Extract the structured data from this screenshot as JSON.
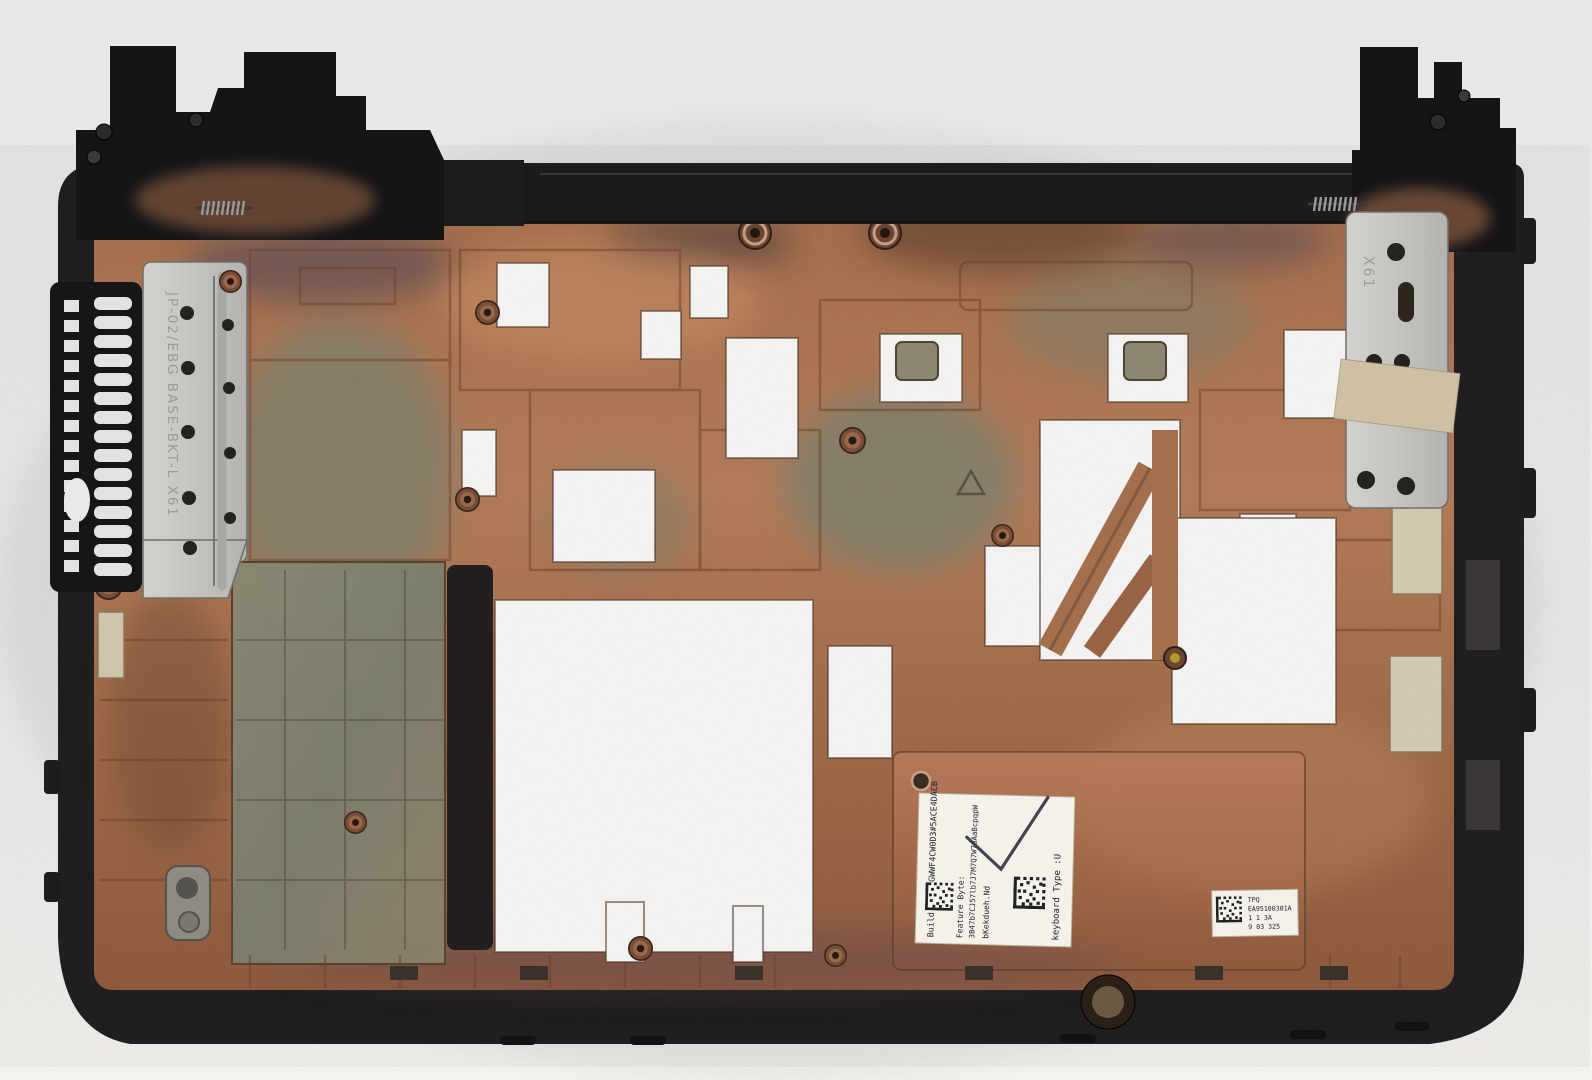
{
  "photo": {
    "subject": "laptop-bottom-case-interior"
  },
  "markings": {
    "left_bracket": {
      "etched_text": "JP-02/EBG  BASE-BKT-L  X61"
    },
    "right_bracket": {
      "etched_text": "X61"
    }
  },
  "service_label": {
    "build_id": "Build ID: 1GWWF4CW0D3#5ACE4DACB",
    "feature_byte_label": "Feature Byte:",
    "feature_byte_value": "3B47b7CJ57lb7J7M7Q7W7dAaBcpqpW",
    "config_code": "bKekdueh.Nd",
    "keyboard_type": "keyboard Type :U"
  },
  "part_label": {
    "line1": "TPQ",
    "line2": "EA95100301A",
    "line3": "1 1 3A",
    "line4": "9 03 325"
  },
  "palette": {
    "background": "#ebebed",
    "plastic_black": "#1d1c1f",
    "copper": "#b07753",
    "oxidized_green": "#7d8270",
    "bracket_silver": "#c9c8c4",
    "label_white": "#f3f1ea",
    "tape_beige": "#cdc0a4"
  }
}
